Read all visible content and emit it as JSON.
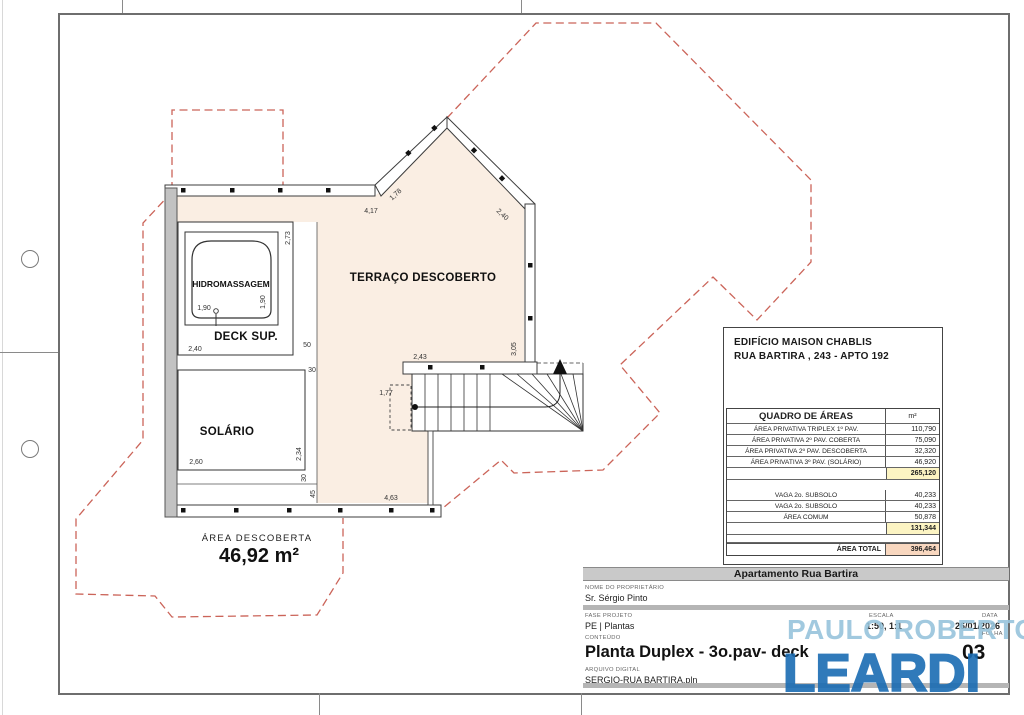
{
  "plan": {
    "colors": {
      "terrace_fill": "#faeee3",
      "projection_red": "#cb6459",
      "wall_grey": "#c2c2c2"
    },
    "labels": {
      "terrace": "TERRAÇO DESCOBERTO",
      "hidro": "HIDROMASSAGEM",
      "deck": "DECK SUP.",
      "solario": "SOLÁRIO",
      "area_caption": "ÁREA DESCOBERTA",
      "area_value": "46,92 m²"
    },
    "dims": {
      "top": "4,17",
      "diag_left": "1,78",
      "diag_right": "2,40",
      "stair_top": "2,43",
      "right_wall": "3,05",
      "stair_left": "1,77",
      "bottom": "4,63",
      "tub_w": "1,90",
      "tub_h": "1,90",
      "tub_col": "2,73",
      "deck_w": "2,40",
      "seg50": "50",
      "seg30a": "30",
      "sol_w": "2,60",
      "sol_h": "2,34",
      "seg30b": "30",
      "seg45": "45"
    }
  },
  "areas_table": {
    "building_line1": "EDIFÍCIO MAISON CHABLIS",
    "building_line2": "RUA BARTIRA , 243 - APTO 192",
    "header": {
      "label": "QUADRO DE ÁREAS",
      "unit": "m²"
    },
    "highlight_yellow": "#fcf4c3",
    "highlight_orange": "#f8d7bf",
    "rows": [
      {
        "label": "ÁREA PRIVATIVA TRIPLEX 1º PAV.",
        "value": "110,790"
      },
      {
        "label": "ÁREA PRIVATIVA 2º PAV. COBERTA",
        "value": "75,090"
      },
      {
        "label": "ÁREA PRIVATIVA 2º PAV. DESCOBERTA",
        "value": "32,320"
      },
      {
        "label": "ÁREA PRIVATIVA 3º PAV. (SOLÁRIO)",
        "value": "46,920"
      },
      {
        "label": "",
        "value": "265,120"
      },
      {
        "label": "",
        "value": ""
      },
      {
        "label": "VAGA 2o. SUBSOLO",
        "value": "40,233"
      },
      {
        "label": "VAGA 2o. SUBSOLO",
        "value": "40,233"
      },
      {
        "label": "ÁREA COMUM",
        "value": "50,878"
      },
      {
        "label": "",
        "value": "131,344"
      },
      {
        "label": "",
        "value": ""
      },
      {
        "label": "ÁREA TOTAL",
        "value": "396,464"
      }
    ]
  },
  "title_block": {
    "project_title": "Apartamento Rua Bartira",
    "owner_caption": "NOME DO PROPRIETÁRIO",
    "owner": "Sr. Sérgio Pinto",
    "phase_caption": "FASE PROJETO",
    "phase": "PE | Plantas",
    "scale_caption": "ESCALA",
    "scale": "1:50, 1:1",
    "date_caption": "DATA",
    "date": "26/01/2026",
    "content_caption": "CONTEÚDO",
    "content": "Planta Duplex - 3o.pav- deck",
    "sheet_caption": "FOLHA",
    "sheet": "03",
    "file_caption": "ARQUIVO DIGITAL",
    "file": "SERGIO-RUA BARTIRA.pln"
  },
  "logo": {
    "line1": "PAULO ROBERTO",
    "line2": "LEARDI",
    "color_light": "#97c4dc",
    "color_dark": "#1a6cb3"
  }
}
